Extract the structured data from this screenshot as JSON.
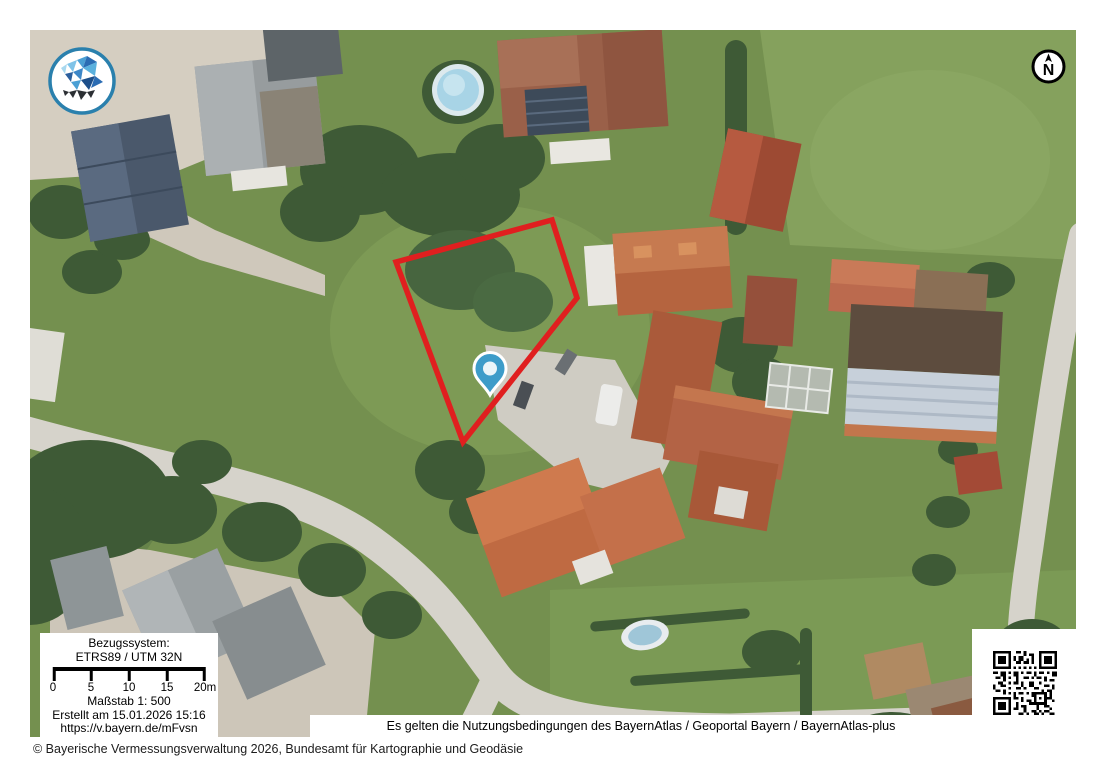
{
  "north_arrow": {
    "label": "N"
  },
  "info_box": {
    "reference_system_label": "Bezugssystem:",
    "reference_system_value": "ETRS89 / UTM 32N",
    "scale_tick_labels": [
      "0",
      "5",
      "10",
      "15",
      "20m"
    ],
    "scale_text": "Maßstab 1: 500",
    "created_text": "Erstellt am 15.01.2026 15:16",
    "short_url": "https://v.bayern.de/mFvsn"
  },
  "footer": {
    "terms_text": "Es gelten die Nutzungsbedingungen des BayernAtlas / Geoportal Bayern / BayernAtlas-plus",
    "copyright_text": "© Bayerische Vermessungsverwaltung 2026, Bundesamt für Kartographie und Geodäsie"
  },
  "map": {
    "type": "aerial-orthophoto",
    "overlays": [
      "parcel-outline",
      "location-marker"
    ]
  },
  "colors": {
    "parcel_outline": "#e01f1f",
    "marker_fill": "#3d9cc9",
    "marker_inner": "#eaf5f9",
    "logo_ring": "#2a80ad"
  }
}
